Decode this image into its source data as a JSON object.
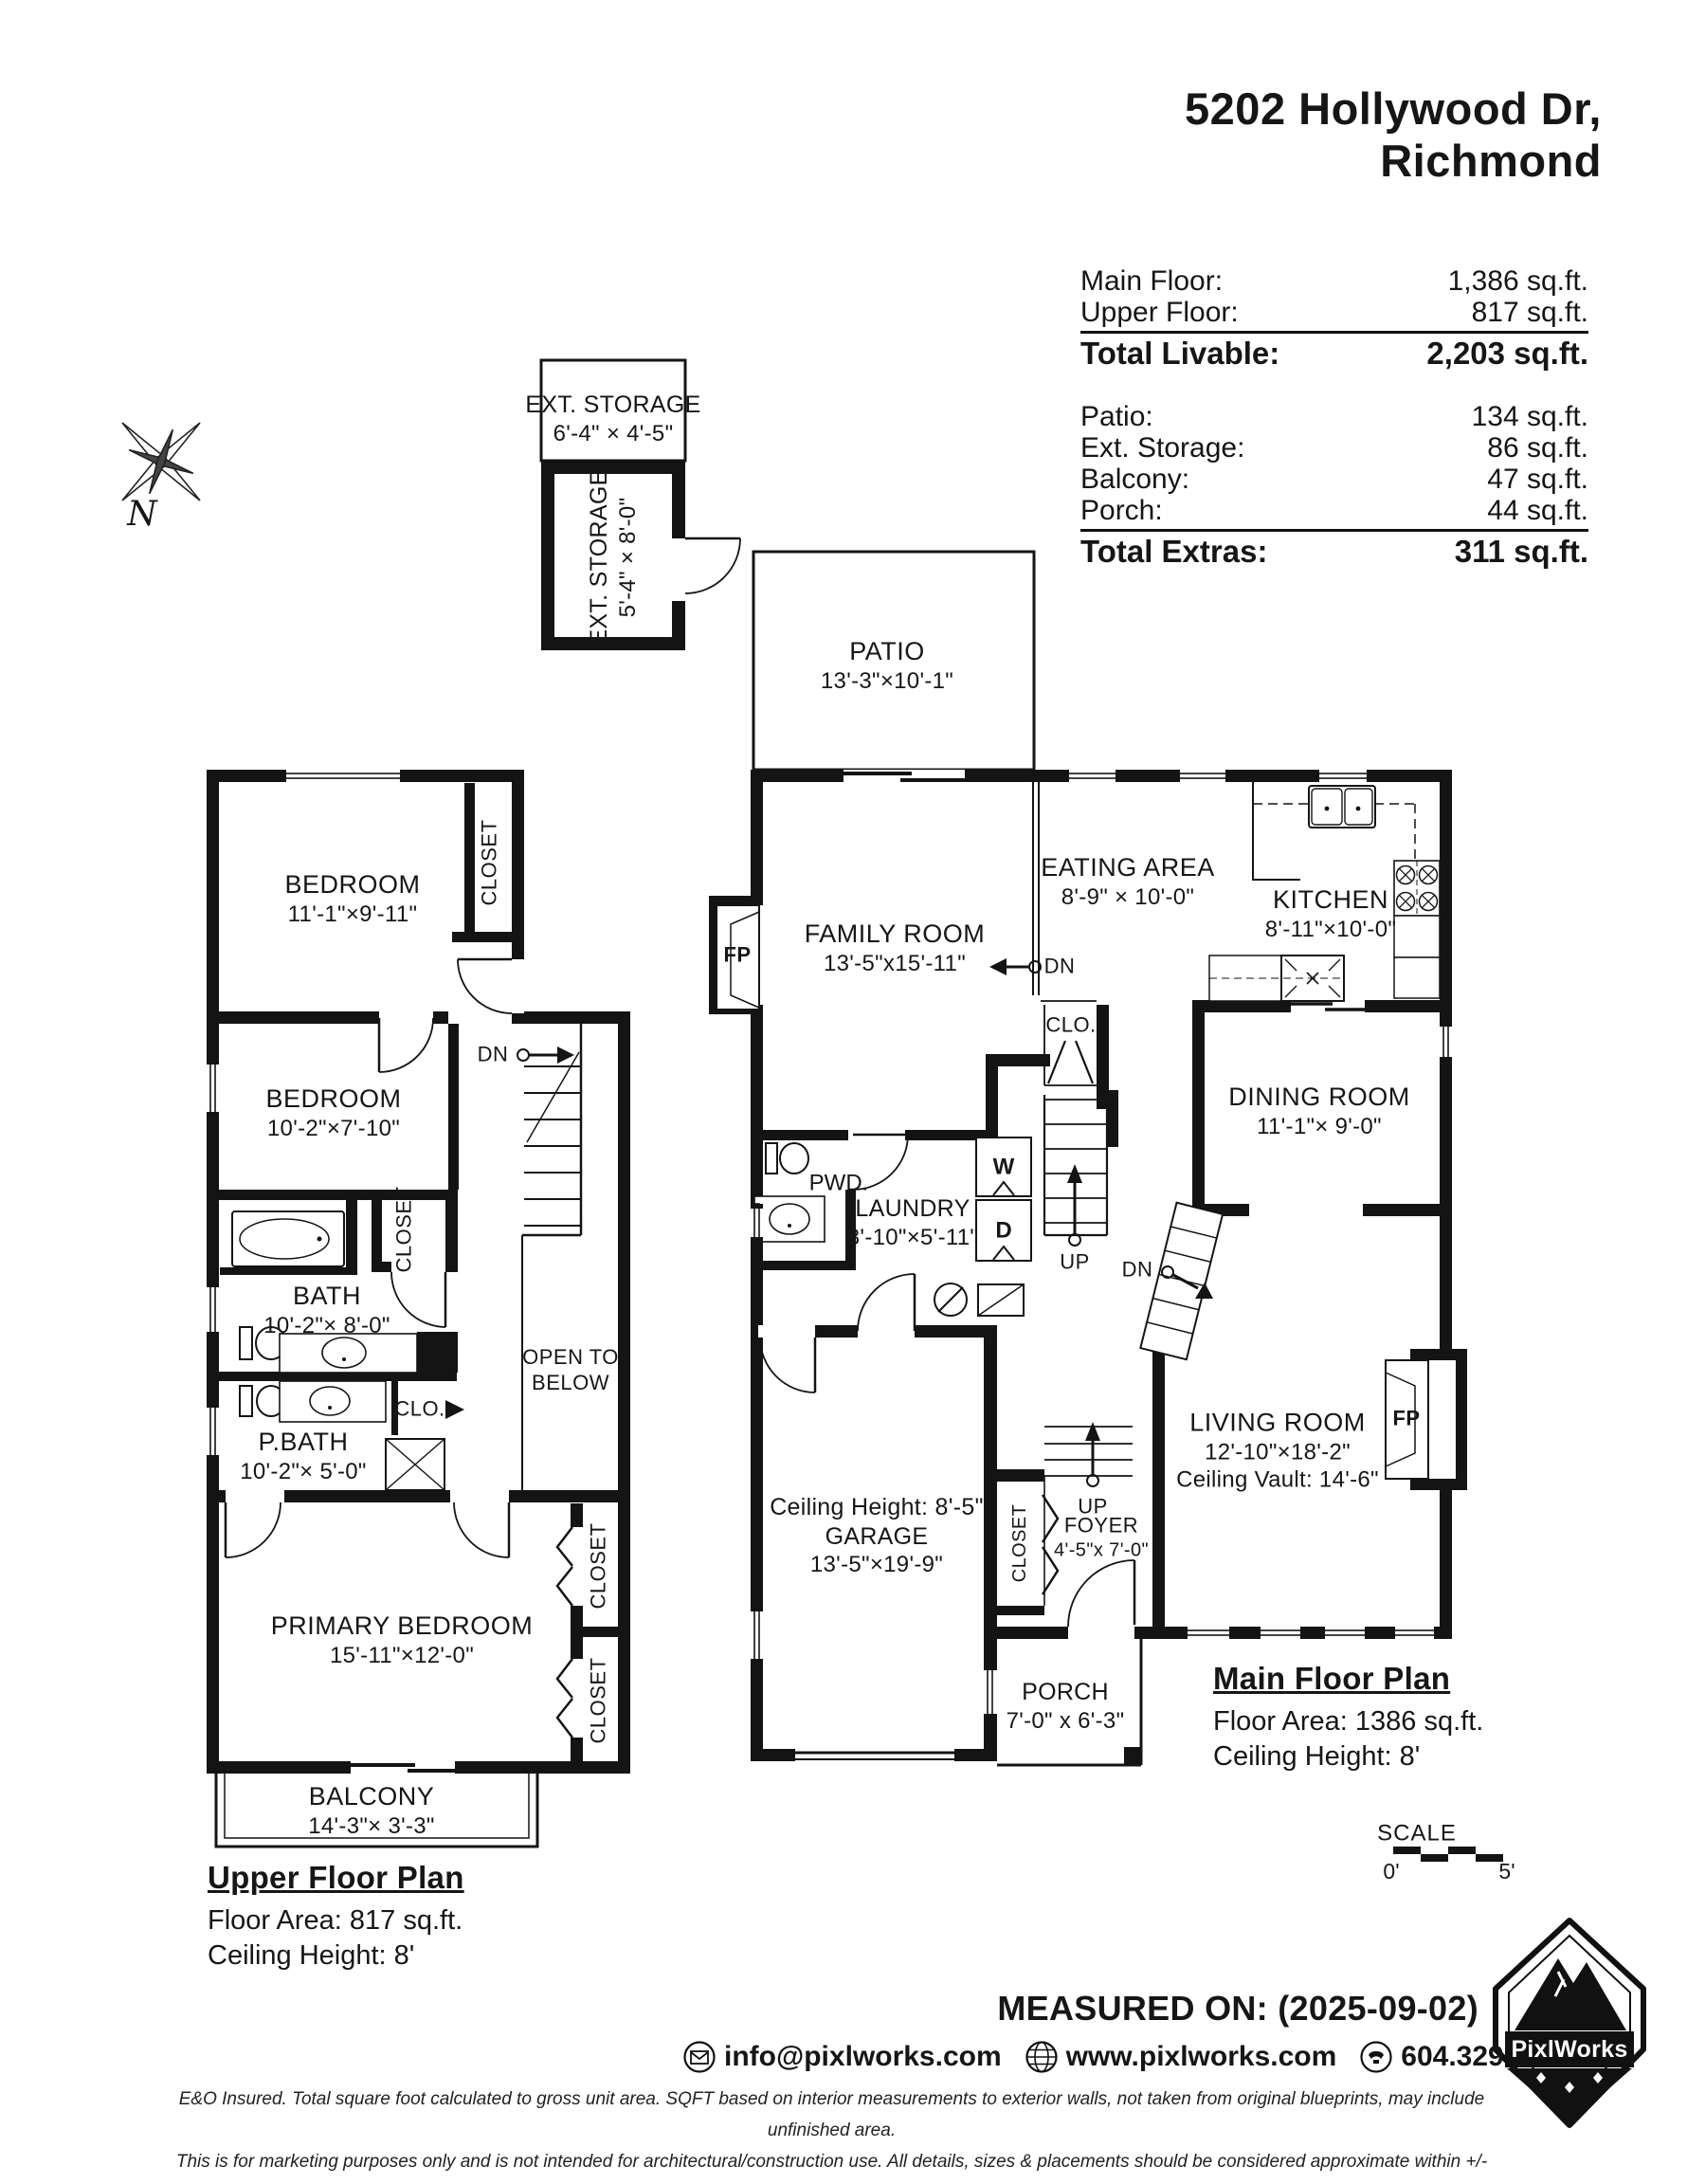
{
  "title": {
    "line1": "5202 Hollywood Dr,",
    "line2": "Richmond"
  },
  "compass": {
    "n": "N"
  },
  "summary": {
    "livable": {
      "rows": [
        {
          "label": "Main Floor:",
          "value": "1,386 sq.ft."
        },
        {
          "label": "Upper Floor:",
          "value": "817 sq.ft."
        }
      ],
      "total": {
        "label": "Total Livable:",
        "value": "2,203 sq.ft."
      }
    },
    "extras": {
      "rows": [
        {
          "label": "Patio:",
          "value": "134 sq.ft."
        },
        {
          "label": "Ext. Storage:",
          "value": "86 sq.ft."
        },
        {
          "label": "Balcony:",
          "value": "47 sq.ft."
        },
        {
          "label": "Porch:",
          "value": "44 sq.ft."
        }
      ],
      "total": {
        "label": "Total Extras:",
        "value": "311 sq.ft."
      }
    }
  },
  "outbuilding": {
    "top": {
      "name": "EXT. STORAGE",
      "dims": "6'-4\" × 4'-5\""
    },
    "side": {
      "name": "EXT. STORAGE",
      "dims": "5'-4\" × 8'-0\""
    }
  },
  "patio": {
    "name": "PATIO",
    "dims": "13'-3\"×10'-1\""
  },
  "upper": {
    "bedroom1": {
      "name": "BEDROOM",
      "dims": "11'-1\"×9'-11\""
    },
    "bedroom2": {
      "name": "BEDROOM",
      "dims": "10'-2\"×7'-10\""
    },
    "bath": {
      "name": "BATH",
      "dims": "10'-2\"× 8'-0\""
    },
    "pbath": {
      "name": "P.BATH",
      "dims": "10'-2\"× 5'-0\""
    },
    "primary": {
      "name": "PRIMARY BEDROOM",
      "dims": "15'-11\"×12'-0\""
    },
    "balcony": {
      "name": "BALCONY",
      "dims": "14'-3\"× 3'-3\""
    },
    "open1": "OPEN TO",
    "open2": "BELOW",
    "closet": "CLOSET",
    "clo": "CLO.",
    "dn": "DN",
    "label": {
      "title": "Upper Floor Plan",
      "area": "Floor Area: 817 sq.ft.",
      "ceiling": "Ceiling Height: 8'"
    }
  },
  "main": {
    "family": {
      "name": "FAMILY ROOM",
      "dims": "13'-5\"x15'-11\""
    },
    "eating": {
      "name": "EATING AREA",
      "dims": "8'-9\" × 10'-0\""
    },
    "kitchen": {
      "name": "KITCHEN",
      "dims": "8'-11\"×10'-0\""
    },
    "dining": {
      "name": "DINING ROOM",
      "dims": "11'-1\"× 9'-0\""
    },
    "laundry": {
      "name": "LAUNDRY",
      "dims": "8'-10\"×5'-11\""
    },
    "living": {
      "name": "LIVING ROOM",
      "dims": "12'-10\"×18'-2\"",
      "vault": "Ceiling Vault: 14'-6\""
    },
    "garage": {
      "ceiling": "Ceiling Height: 8'-5\"",
      "name": "GARAGE",
      "dims": "13'-5\"×19'-9\""
    },
    "foyer": {
      "name": "FOYER",
      "dims": "4'-5\"x 7'-0\""
    },
    "porch": {
      "name": "PORCH",
      "dims": "7'-0\" x 6'-3\""
    },
    "pwd": "PWD.",
    "clo": "CLO.",
    "closet": "CLOSET",
    "washer": "W",
    "dryer": "D",
    "up": "UP",
    "dn": "DN",
    "fp": "FP",
    "label": {
      "title": "Main Floor Plan",
      "area": "Floor Area: 1386 sq.ft.",
      "ceiling": "Ceiling Height: 8'"
    }
  },
  "scale": {
    "label": "SCALE",
    "start": "0'",
    "end": "5'"
  },
  "footer": {
    "measured": "MEASURED ON: (2025-09-02)",
    "email": "info@pixlworks.com",
    "web": "www.pixlworks.com",
    "phone": "604.329.5788",
    "fine1": "E&O Insured.  Total square foot calculated to gross unit area. SQFT based on interior measurements to exterior walls, not taken from original blueprints, may include unfinished area.",
    "fine2": "This is for marketing purposes only and is not intended for architectural/construction use.  All details, sizes & placements should be considered approximate within +/- 2%  tolerance.",
    "brand": "PixlWorks"
  }
}
